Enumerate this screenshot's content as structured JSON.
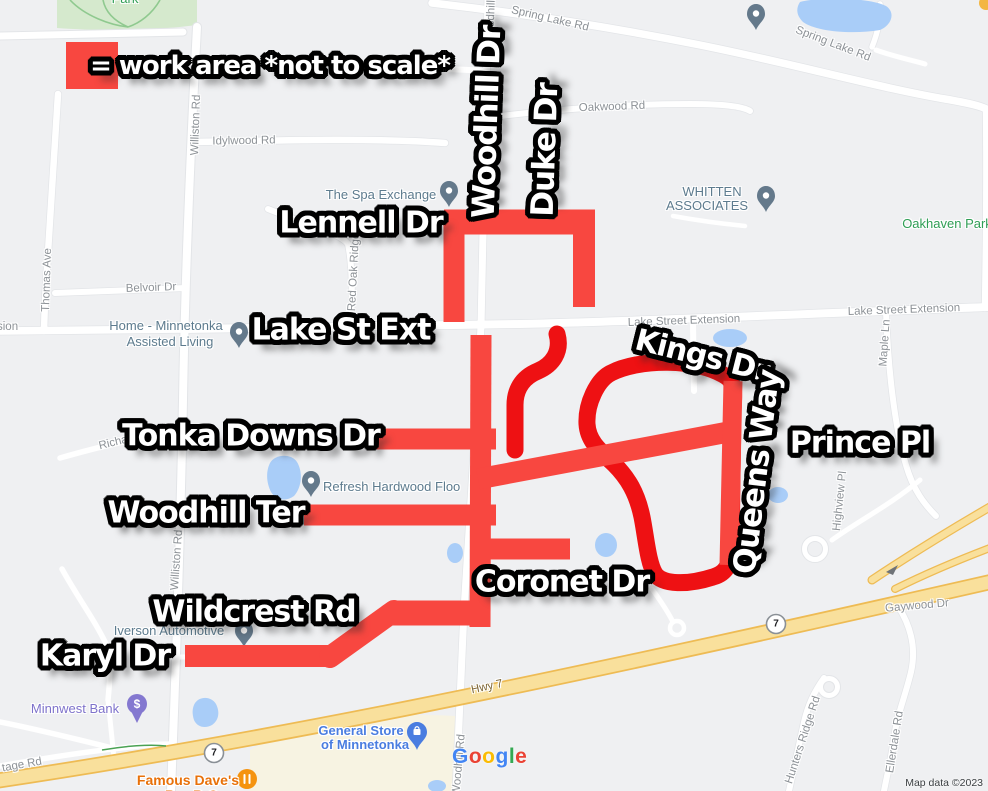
{
  "colors": {
    "land": "#eff0f2",
    "road_fill": "#ffffff",
    "road_casing": "#e3e5e8",
    "water": "#a9cdf8",
    "park_fill": "#d5e9cd",
    "park_line": "#8fc98f",
    "trail": "#4aa254",
    "commercial": "#f7f3e2",
    "hwy_fill": "#f9e09c",
    "hwy_casing": "#eebb54",
    "work_area_light": "#f84740",
    "work_area_dark": "#ee1113",
    "road_label": "#8d9297",
    "poi_label": "#5d7b8e",
    "park_label": "#2f9e55",
    "bank_label": "#7e72cb",
    "store_label": "#4a7de0",
    "restaurant_label": "#e8710a",
    "restaurant_pin": "#f5930f",
    "bank_pin": "#8478d0",
    "store_pin": "#4a7de0",
    "pin_slate": "#64798b",
    "hwy_label": "#7d6638",
    "shield_ring": "#8a9096",
    "attribution": "#3c4043",
    "corner_pin": "#f3b643"
  },
  "legend": {
    "text": "= work area *not to scale*"
  },
  "work_area_labels": {
    "woodhill_dr": "Woodhill Dr",
    "duke_dr": "Duke Dr",
    "lennell_dr": "Lennell Dr",
    "lake_st_ext": "Lake St Ext",
    "kings_dr": "Kings Dr",
    "queens_way": "Queens Way",
    "prince_pl": "Prince Pl",
    "tonka_downs_dr": "Tonka Downs Dr",
    "woodhill_ter": "Woodhill Ter",
    "coronet_dr": "Coronet Dr",
    "wildcrest_rd": "Wildcrest Rd",
    "karyl_dr": "Karyl Dr"
  },
  "road_labels": {
    "spring_lake_rd_w": "Spring Lake Rd",
    "spring_lake_rd_e": "Spring Lake Rd",
    "oakwood_rd": "Oakwood Rd",
    "idylwood_rd": "Idylwood Rd",
    "belvoir_dr": "Belvoir Dr",
    "thomas_ave": "Thomas Ave",
    "williston_rd_n": "Williston Rd",
    "williston_rd_s": "Williston Rd",
    "woodhill_n": "Woodhill",
    "woodhill_rd_s": "Woodhill Rd",
    "red_oak_ridge": "Red Oak Ridge",
    "lake_street_extension_mid": "Lake Street Extension",
    "lake_street_extension_e": "Lake Street Extension",
    "extension_fragment": "sion",
    "richards": "Richards",
    "maple_ln": "Maple Ln",
    "highview_pl": "Highview Pl",
    "hwy_7": "Hwy 7",
    "shield_7": "7",
    "gaywood_dr": "Gaywood Dr",
    "hunters_ridge_rd": "Hunters Ridge Rd",
    "ellerdale_rd": "Ellerdale Rd",
    "frontage_rd": "tage Rd"
  },
  "poi_labels": {
    "park": "Park",
    "oakhaven_park": "Oakhaven Park",
    "spa": "The Spa Exchange",
    "whitten_line1": "WHITTEN",
    "whitten_line2": "ASSOCIATES",
    "home_line1": "Home - Minnetonka",
    "home_line2": "Assisted Living",
    "refresh": "Refresh Hardwood Floo",
    "iverson": "Iverson Automotive",
    "minnwest": "Minnwest Bank",
    "bank_pin_symbol": "$",
    "general_line1": "General Store",
    "general_line2": "of Minnetonka",
    "famous_line1": "Famous Dave's",
    "famous_line2": "Bar-B-Que"
  },
  "watermark": {
    "letters": [
      {
        "ch": "G",
        "color": "#4285F4"
      },
      {
        "ch": "o",
        "color": "#EA4335"
      },
      {
        "ch": "o",
        "color": "#FBBC05"
      },
      {
        "ch": "g",
        "color": "#4285F4"
      },
      {
        "ch": "l",
        "color": "#34A853"
      },
      {
        "ch": "e",
        "color": "#EA4335"
      }
    ],
    "attribution": "Map data ©2023"
  }
}
